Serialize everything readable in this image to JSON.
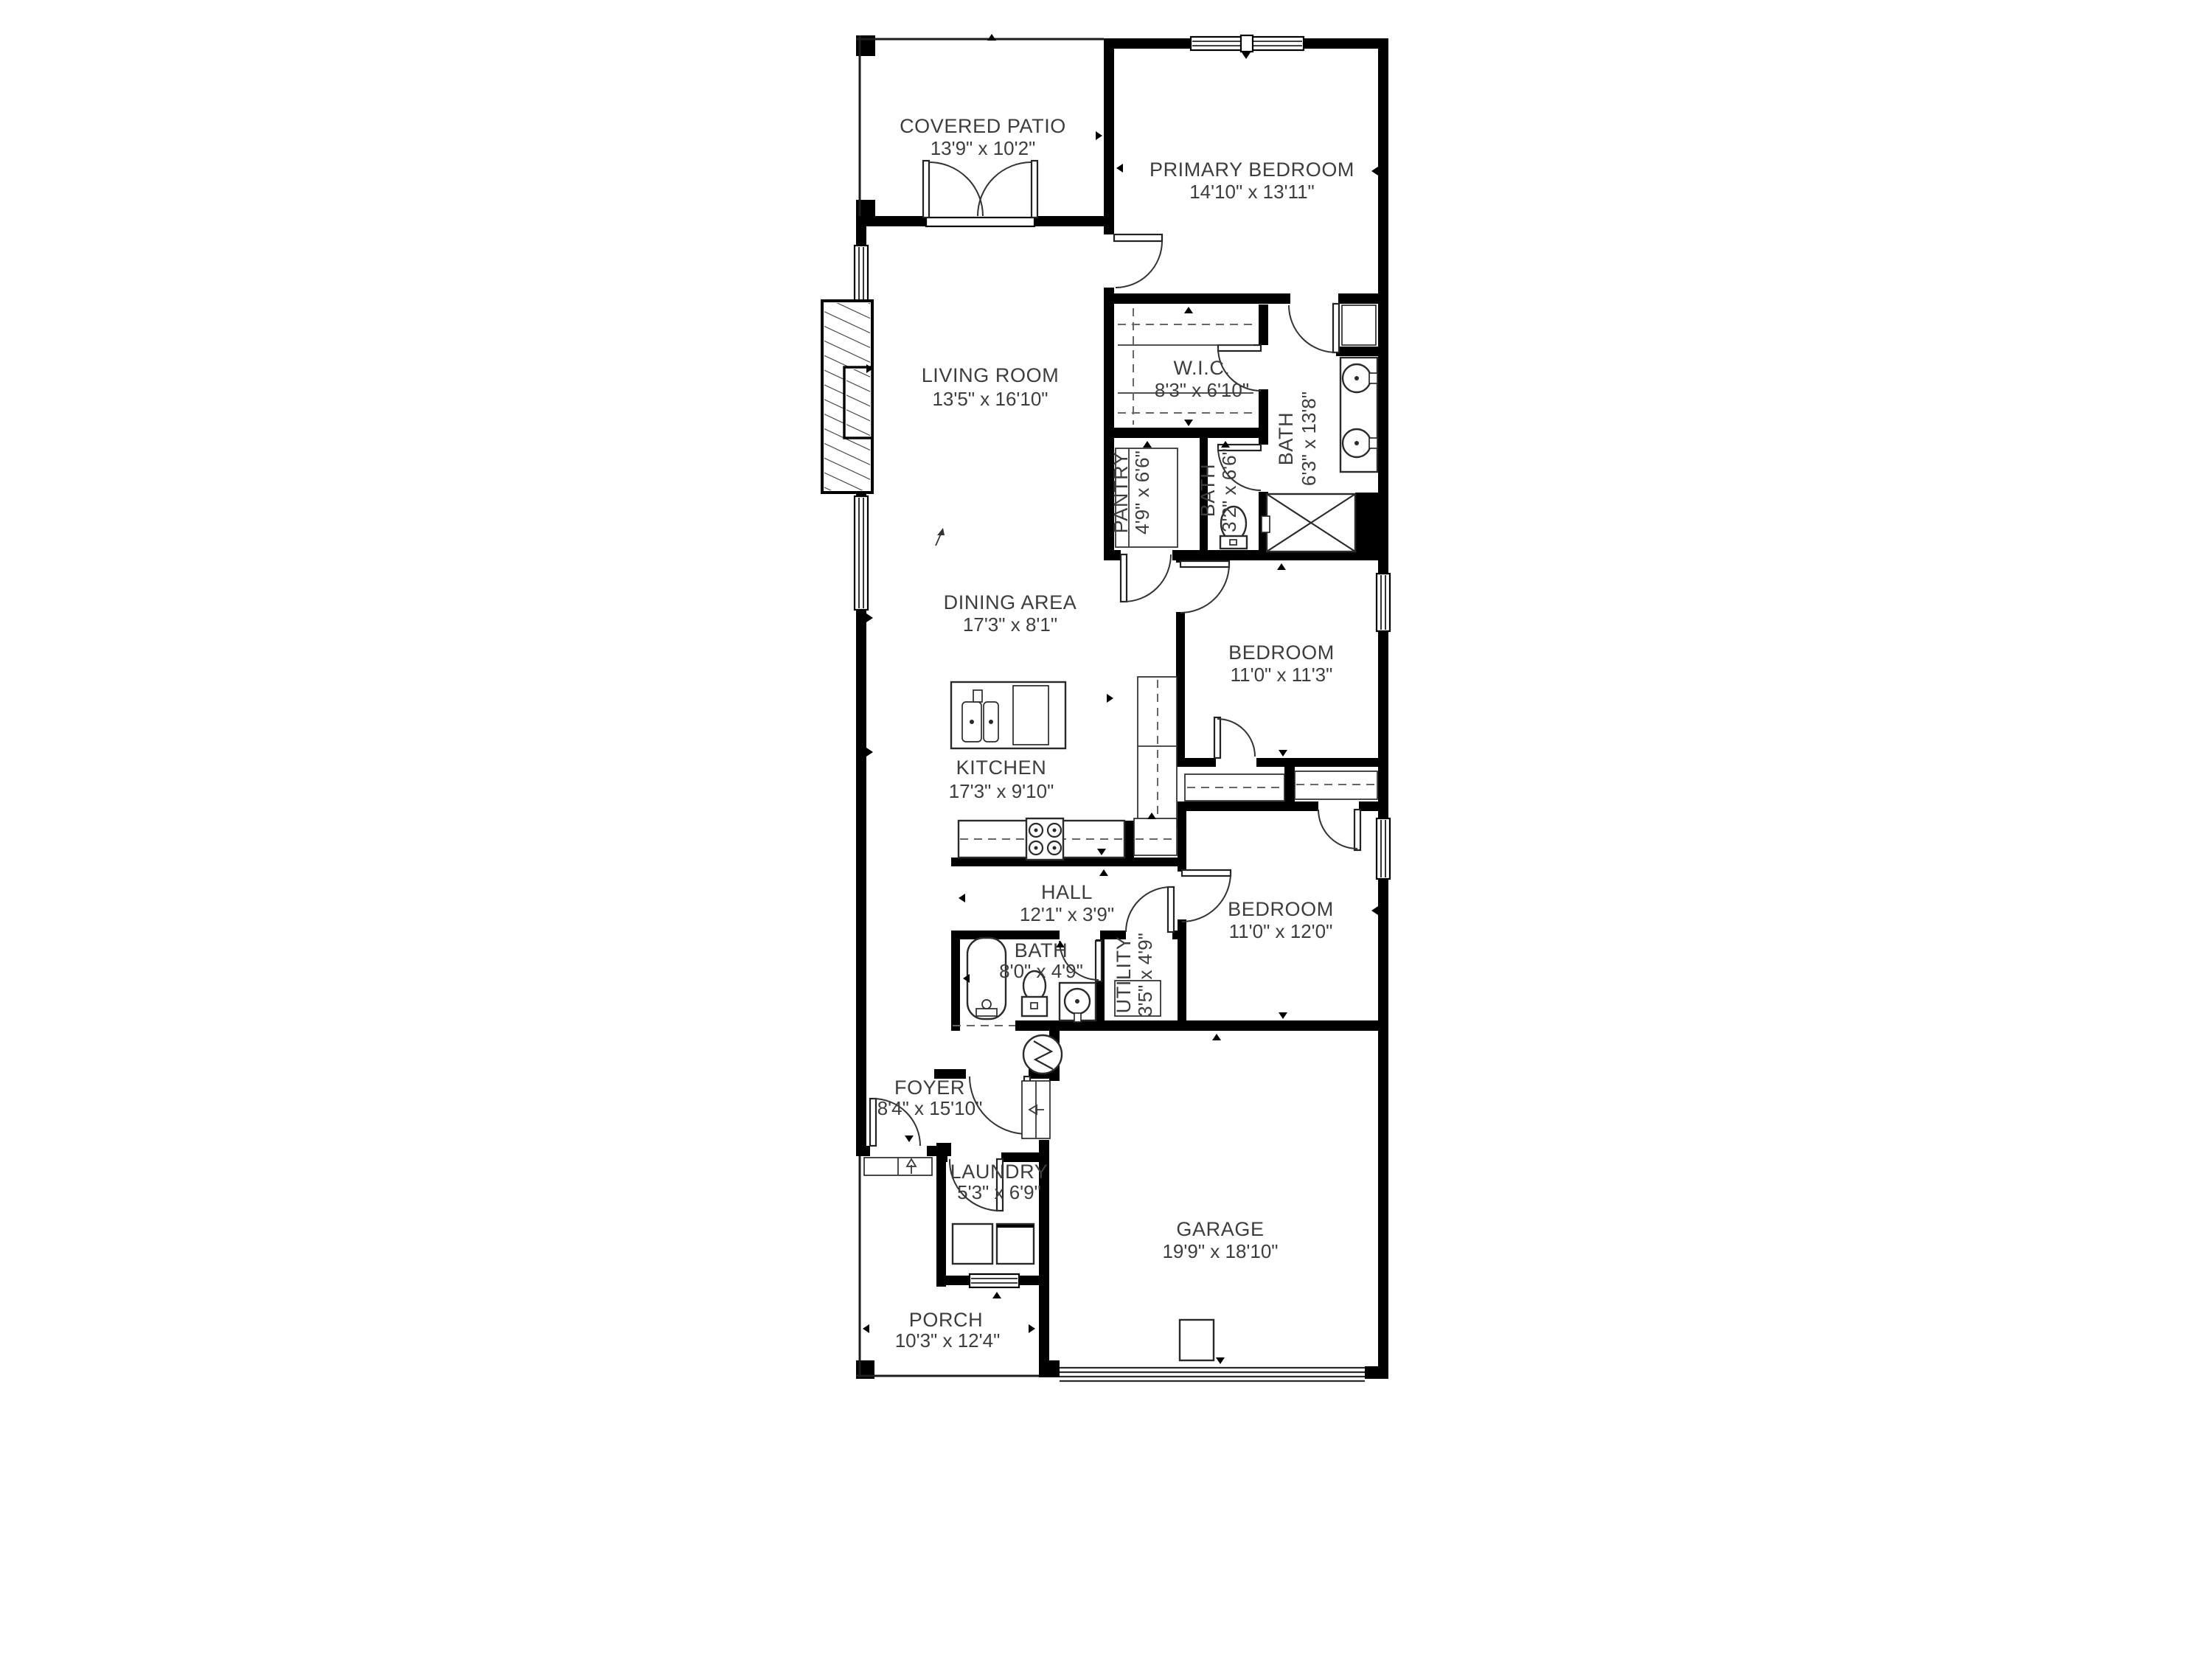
{
  "plan": {
    "type": "residential-floor-plan",
    "wall_color": "#000000",
    "background": "#ffffff",
    "label_color": "#3d3d3d"
  },
  "rooms": [
    {
      "id": "covered-patio",
      "name": "COVERED PATIO",
      "dims": "13'9\" x 10'2\""
    },
    {
      "id": "primary-bedroom",
      "name": "PRIMARY BEDROOM",
      "dims": "14'10\" x 13'11\""
    },
    {
      "id": "living-room",
      "name": "LIVING ROOM",
      "dims": "13'5\" x 16'10\""
    },
    {
      "id": "wic",
      "name": "W.I.C.",
      "dims": "8'3\" x 6'10\""
    },
    {
      "id": "primary-bath",
      "name": "BATH",
      "dims": "6'3\" x 13'8\""
    },
    {
      "id": "pantry",
      "name": "PANTRY",
      "dims": "4'9\" x 6'6\""
    },
    {
      "id": "toilet-room",
      "name": "BATH",
      "dims": "3'2\" x 6'6\""
    },
    {
      "id": "dining-area",
      "name": "DINING AREA",
      "dims": "17'3\" x 8'1\""
    },
    {
      "id": "bedroom-1",
      "name": "BEDROOM",
      "dims": "11'0\" x 11'3\""
    },
    {
      "id": "kitchen",
      "name": "KITCHEN",
      "dims": "17'3\" x 9'10\""
    },
    {
      "id": "hall",
      "name": "HALL",
      "dims": "12'1\" x 3'9\""
    },
    {
      "id": "hall-bath",
      "name": "BATH",
      "dims": "8'0\" x 4'9\""
    },
    {
      "id": "utility",
      "name": "UTILITY",
      "dims": "3'5\" x 4'9\""
    },
    {
      "id": "bedroom-2",
      "name": "BEDROOM",
      "dims": "11'0\" x 12'0\""
    },
    {
      "id": "foyer",
      "name": "FOYER",
      "dims": "8'4\" x 15'10\""
    },
    {
      "id": "laundry",
      "name": "LAUNDRY",
      "dims": "5'3\" x 6'9\""
    },
    {
      "id": "garage",
      "name": "GARAGE",
      "dims": "19'9\" x 18'10\""
    },
    {
      "id": "porch",
      "name": "PORCH",
      "dims": "10'3\" x 12'4\""
    }
  ],
  "symbols": {
    "water_heater": "water-heater-lightning-icon",
    "north_arrow": "north-arrow-icon",
    "shower": "shower-x-icon",
    "fireplace": "fireplace-hatch-icon"
  }
}
